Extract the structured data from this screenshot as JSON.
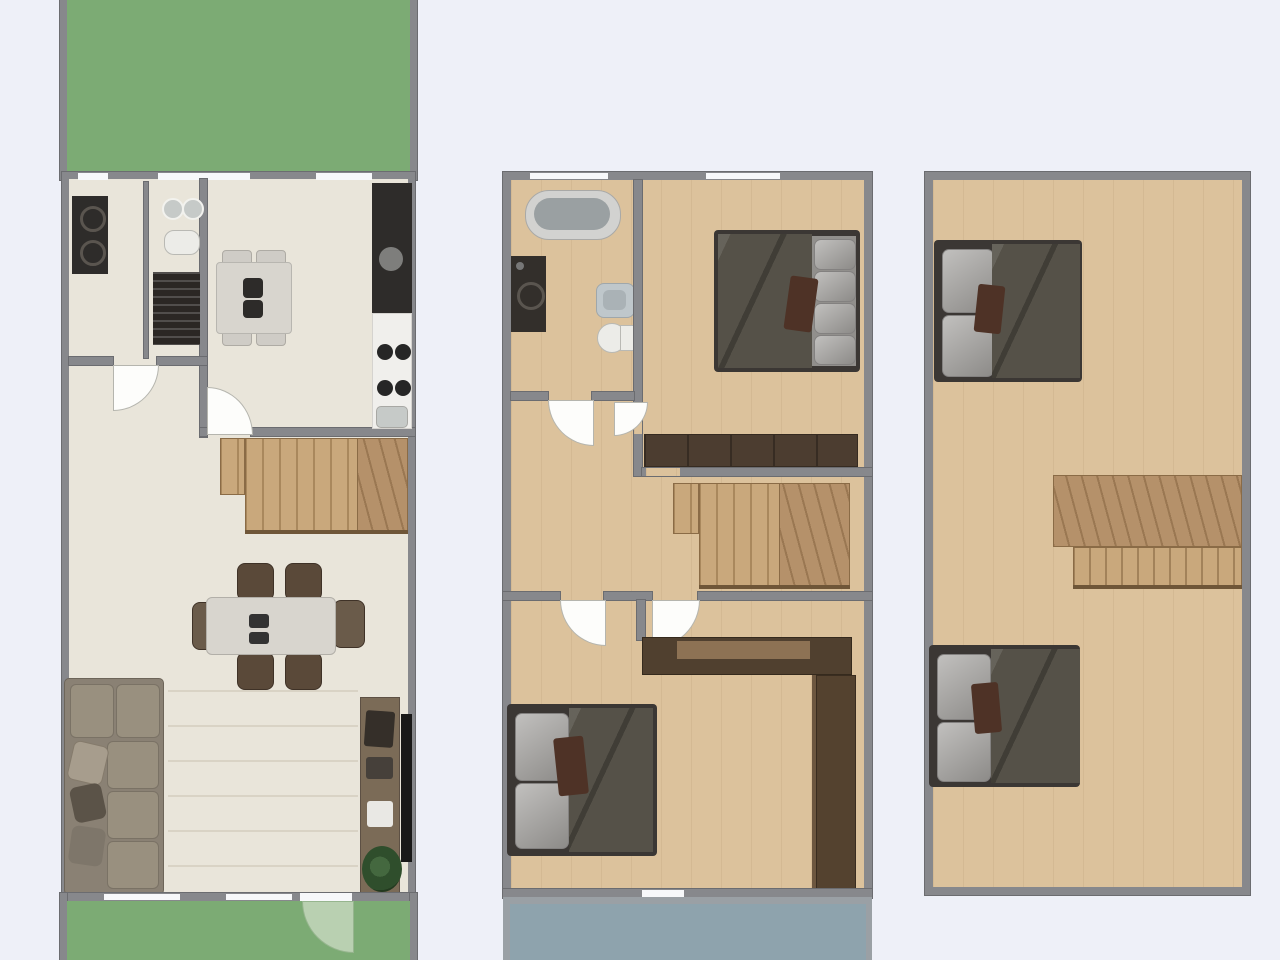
{
  "title": "Three-storey house floor plans",
  "plan_type": "top-down architectural floor plan, no text labels",
  "colors": {
    "bg": "#eef0f8",
    "wall": "#87888c",
    "wallDark": "#6b6c70",
    "windowWhite": "#f7f8fa",
    "floorCream": "#e9e5da",
    "floorCreamLine": "#d9d3c5",
    "floorWood": "#dcc29c",
    "garden": "#7cab74",
    "gardenDoor": "#b9d0b1",
    "balcony": "#8ea3ad",
    "balconyWall": "#9aa0a5",
    "stair": "#c9a87c",
    "stairDark": "#b5916a",
    "stairLine": "#8a6b46",
    "railing": "#6f5638",
    "furnDark": "#50402f",
    "wardrobe": "#4c3d30",
    "bedFrame": "#3b3734",
    "duvet": "#555148",
    "pillow": "#a09e9b",
    "pillowDark": "#838180",
    "accentBrown": "#4e3226",
    "sofa": "#8a8174",
    "sofaCushion": "#99907f",
    "sofaPillowDark": "#5b5348",
    "counter": "#f0efec",
    "applianceDark": "#2e2c2a",
    "fixture": "#ecece8",
    "fixtureGray": "#c6cac8",
    "tub": "#d2d2d0",
    "tubInner": "#9aa0a2",
    "sinkBlue": "#bfc7cb",
    "tv": "#191919",
    "console": "#7b6b57",
    "plant": "#2f4e2c",
    "tableLight": "#d8d5ce",
    "chairBrown": "#5a4939"
  },
  "floors": [
    {
      "id": "ground-floor",
      "position": "left",
      "outdoor": [
        "garden-top",
        "garden-bottom-with-door"
      ],
      "rooms": [
        {
          "name": "utility-room",
          "furniture": [
            "washer-dryer-stack",
            "radiator"
          ]
        },
        {
          "name": "wc",
          "furniture": [
            "twin-round-sinks",
            "toilet"
          ]
        },
        {
          "name": "kitchen",
          "furniture": [
            "tall-dark-cabinet",
            "counter-with-sink",
            "stove-4-burners",
            "small-table-with-chairs"
          ]
        },
        {
          "name": "living-dining-room",
          "furniture": [
            "staircase-up",
            "dining-table-6-chairs",
            "corner-sofa",
            "tv-console",
            "wall-tv",
            "potted-plant"
          ]
        }
      ]
    },
    {
      "id": "first-floor",
      "position": "middle",
      "outdoor": [
        "balcony-bottom"
      ],
      "rooms": [
        {
          "name": "bathroom",
          "furniture": [
            "bathtub",
            "washing-machine",
            "sink",
            "toilet"
          ]
        },
        {
          "name": "bedroom-1",
          "furniture": [
            "double-bed",
            "long-wardrobe"
          ]
        },
        {
          "name": "landing",
          "furniture": [
            "staircase"
          ]
        },
        {
          "name": "bedroom-2",
          "furniture": [
            "double-bed",
            "corner-wardrobe-unit"
          ]
        }
      ]
    },
    {
      "id": "top-floor",
      "position": "right",
      "outdoor": [],
      "rooms": [
        {
          "name": "open-loft",
          "furniture": [
            "double-bed-top",
            "stair-opening",
            "double-bed-bottom"
          ]
        }
      ]
    }
  ]
}
